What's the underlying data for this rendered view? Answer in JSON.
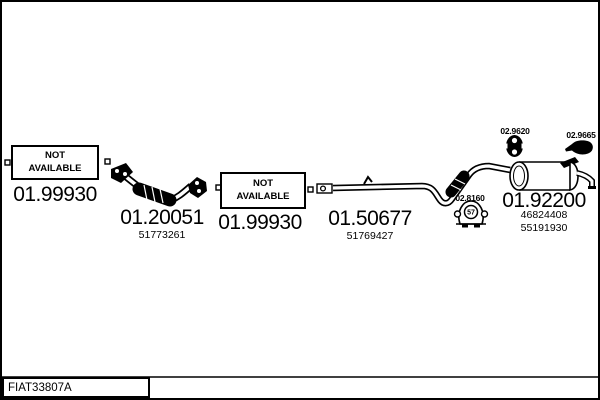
{
  "page": {
    "background": "#ffffff",
    "line_color": "#000000"
  },
  "parts": {
    "front_gasket": {
      "status_line1": "NOT",
      "status_line2": "AVAILABLE",
      "code": "01.99930"
    },
    "front_pipe": {
      "code": "01.20051",
      "oem": "51773261"
    },
    "center_gasket": {
      "status_line1": "NOT",
      "status_line2": "AVAILABLE",
      "code": "01.99930"
    },
    "center_pipe": {
      "code": "01.50677",
      "oem": "51769427"
    },
    "rubber_hanger": {
      "code": "02.8160",
      "marking": "57"
    },
    "rubber_mount": {
      "code": "02.9620"
    },
    "clamp": {
      "code": "02.9665"
    },
    "rear_silencer": {
      "code": "01.92200",
      "oem1": "46824408",
      "oem2": "55191930"
    }
  },
  "footer": {
    "reference": "FIAT33807A"
  }
}
